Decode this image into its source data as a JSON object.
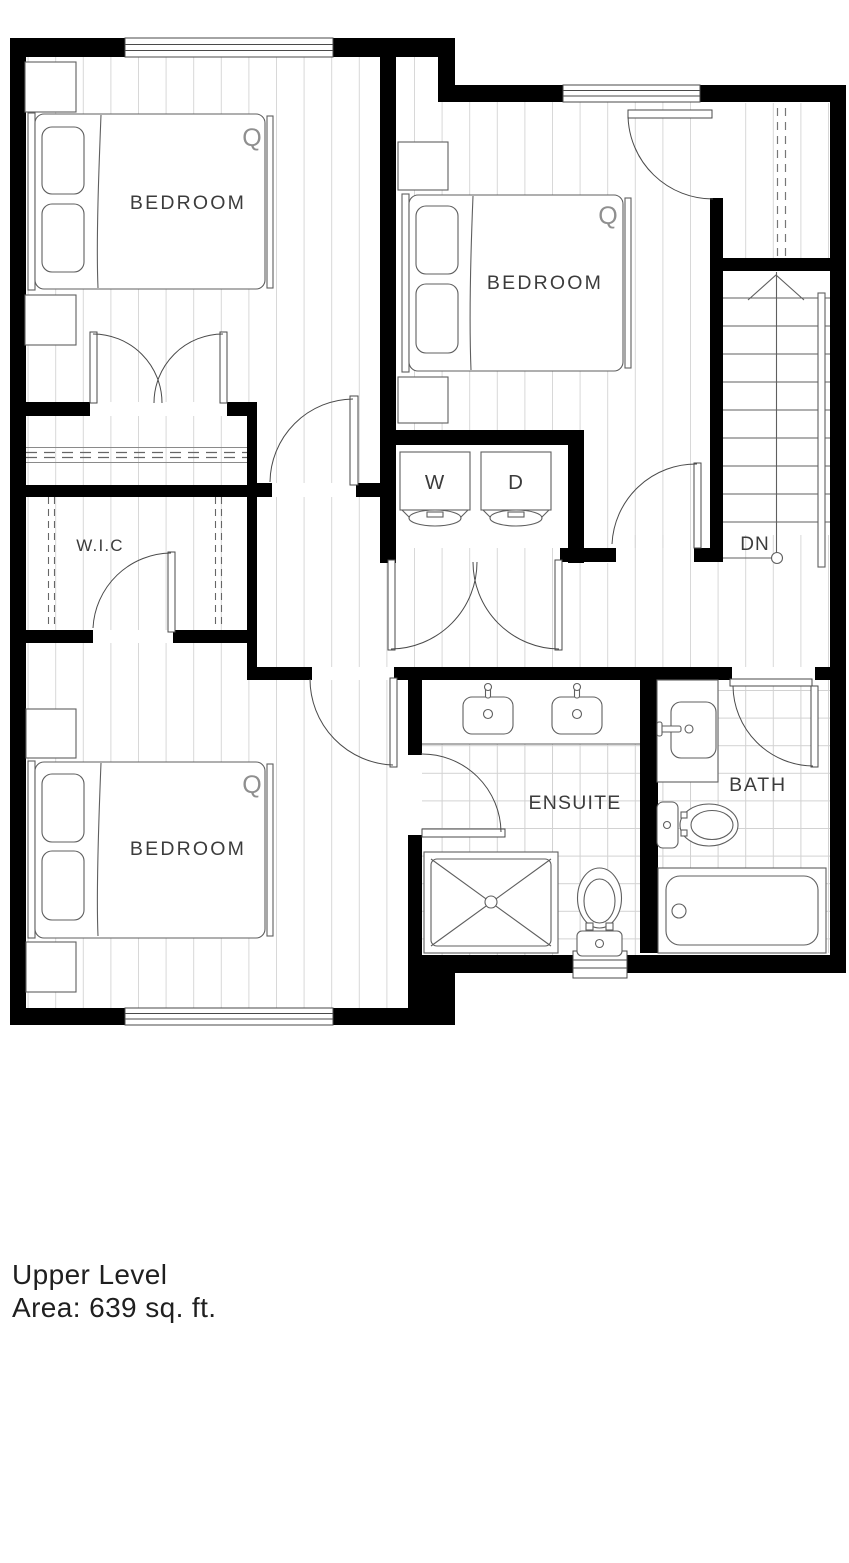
{
  "plan": {
    "labels": {
      "bedroom_top_left": "BEDROOM",
      "bedroom_top_right": "BEDROOM",
      "bedroom_bottom_left": "BEDROOM",
      "wic": "W.I.C",
      "ensuite": "ENSUITE",
      "bath": "BATH",
      "washer": "W",
      "dryer": "D",
      "stairs_down": "DN"
    },
    "bed_brand_mark": "Q",
    "colors": {
      "wall": "#000000",
      "outline": "#4a4a4a",
      "floor_hatch": "#d7d7d7",
      "tile_grid": "#d2d2d2",
      "label_text": "#3c3c3c"
    }
  },
  "caption": {
    "title": "Upper Level",
    "area": "Area: 639 sq. ft."
  }
}
